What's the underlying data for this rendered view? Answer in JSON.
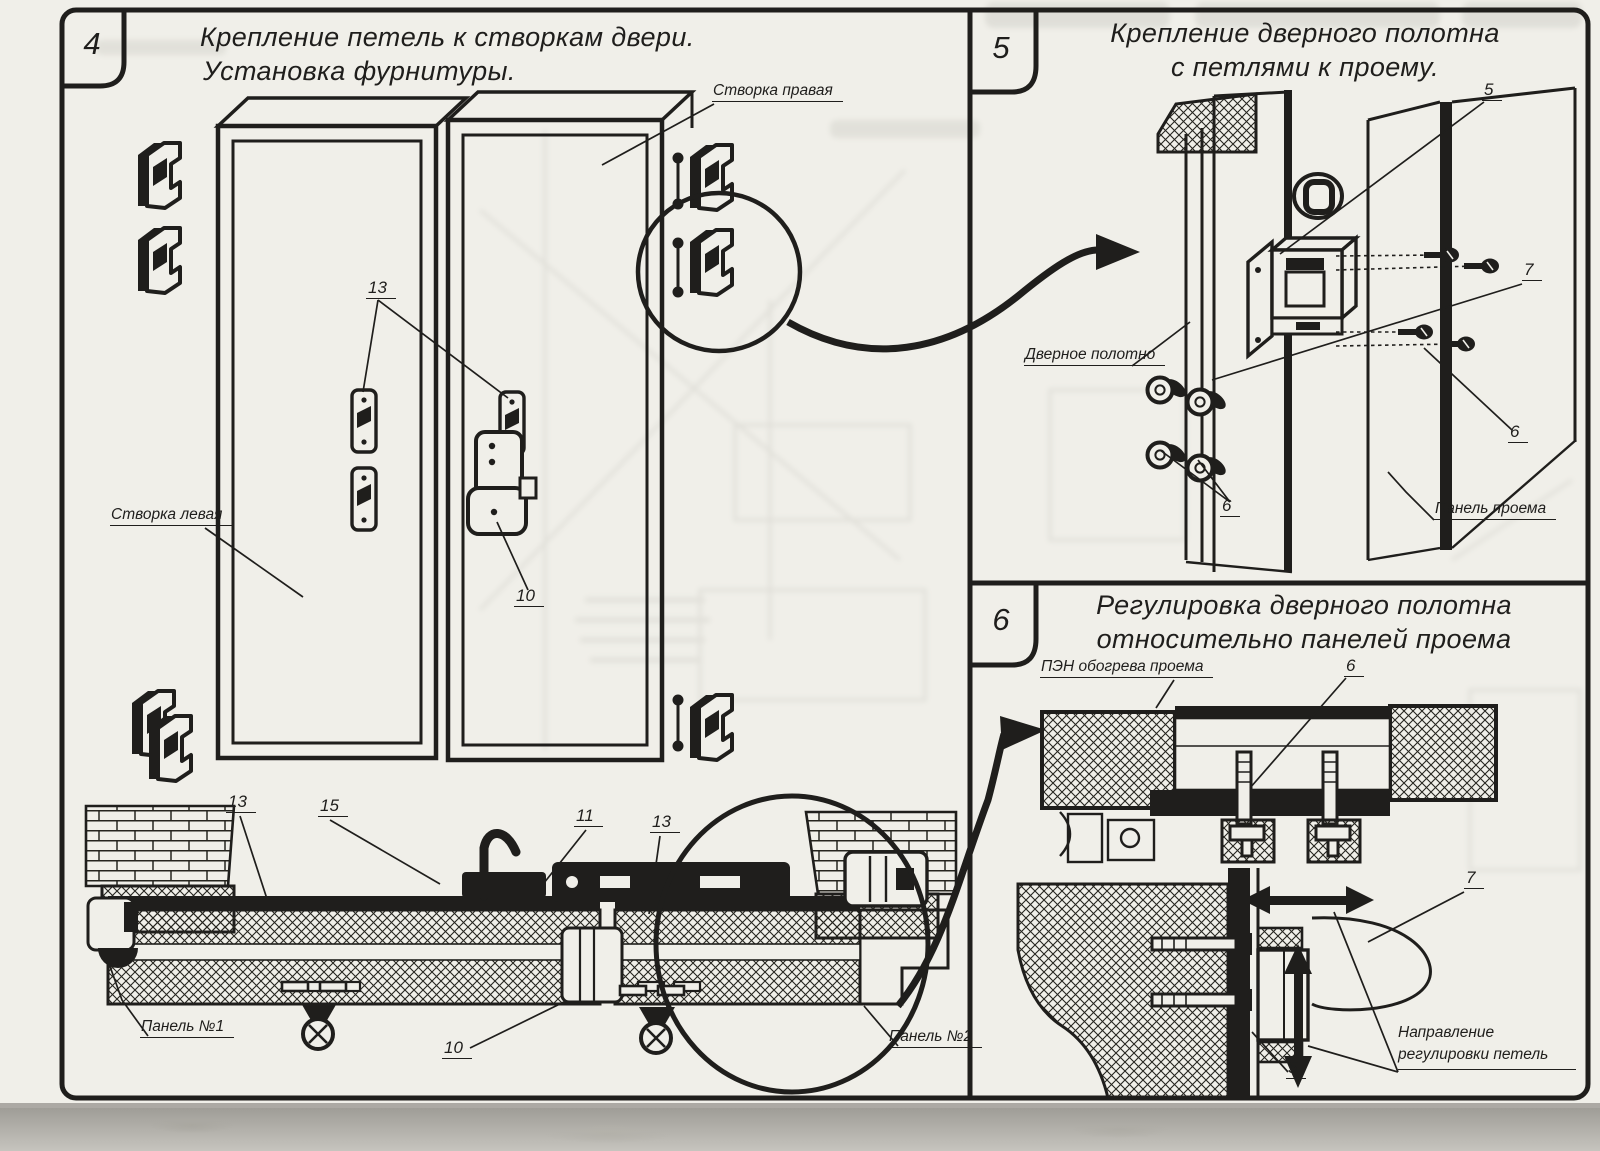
{
  "sheet": {
    "paper_color": "#f0efe9",
    "ink_color": "#1f1e1c"
  },
  "panels": [
    {
      "number": "4",
      "title1": "Крепление петель к створкам двери.",
      "title2": "Установка фурнитуры."
    },
    {
      "number": "5",
      "title1": "Крепление дверного полотна",
      "title2": "с петлями к проему."
    },
    {
      "number": "6",
      "title1": "Регулировка дверного полотна",
      "title2": "относительно панелей проема"
    }
  ],
  "panel4_labels": {
    "leaf_right": "Створка правая",
    "leaf_left": "Створка левая",
    "num_13_hinge_plates": "13",
    "num_10_lock": "10",
    "num_13_section_left": "13",
    "num_15_handle": "15",
    "num_11_lock_section": "11",
    "num_13_section_right": "13",
    "num_10_support": "10",
    "panel_no1": "Панель №1",
    "panel_no2": "Панель №2"
  },
  "panel5_labels": {
    "door_leaf": "Дверное полотно",
    "opening_panel": "Панель проема",
    "num_5": "5",
    "num_7": "7",
    "num_6_right": "6",
    "num_6_screws": "6"
  },
  "panel6_labels": {
    "heater": "ПЭН обогрева проема",
    "num_6": "6",
    "num_7": "7",
    "num_5": "5",
    "adjust_direction": "Направление регулировки петель"
  }
}
